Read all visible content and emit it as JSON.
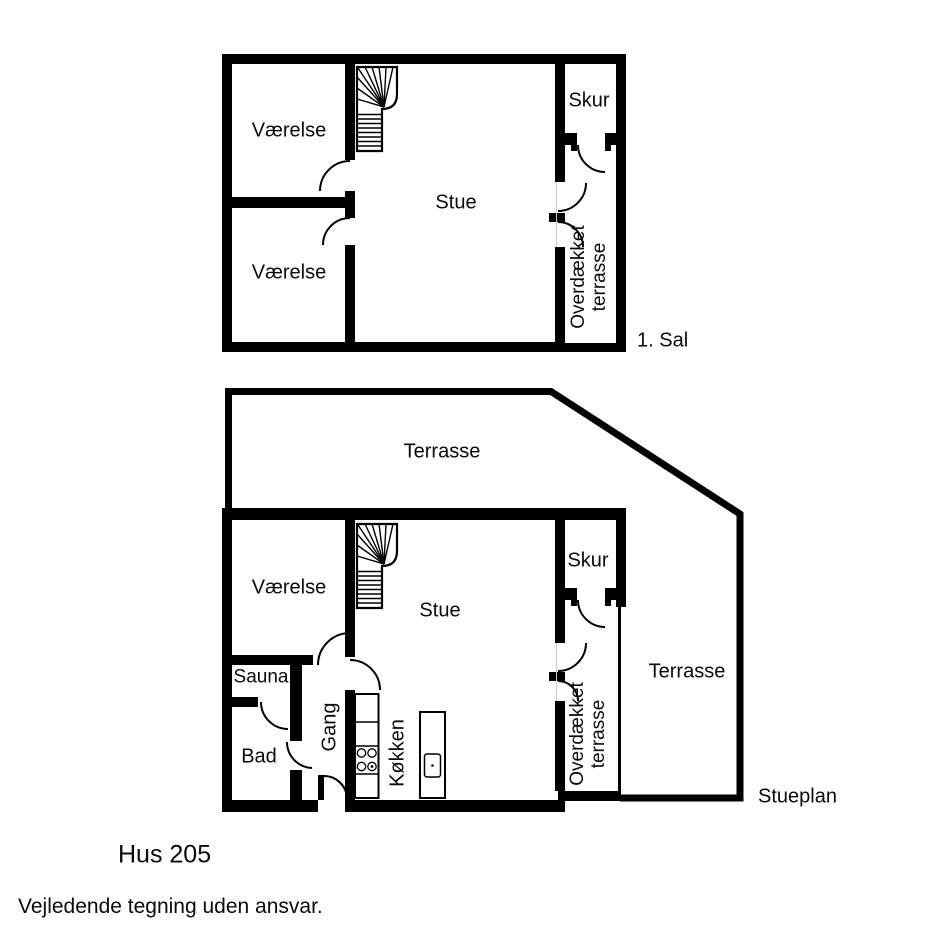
{
  "page": {
    "background": "#ffffff",
    "wall_color": "#000000"
  },
  "floor_plans": {
    "first_floor": {
      "label": "1. Sal",
      "rooms": {
        "vaerelse_top": "Værelse",
        "vaerelse_bottom": "Værelse",
        "stue": "Stue",
        "skur": "Skur",
        "overdaekket_line1": "Overdækket",
        "overdaekket_line2": "terrasse"
      }
    },
    "ground_floor": {
      "label": "Stueplan",
      "rooms": {
        "terrasse_top": "Terrasse",
        "vaerelse": "Værelse",
        "stue": "Stue",
        "skur": "Skur",
        "sauna": "Sauna",
        "bad": "Bad",
        "gang": "Gang",
        "koekken": "Køkken",
        "overdaekket_line1": "Overdækket",
        "overdaekket_line2": "terrasse",
        "terrasse_right": "Terrasse"
      }
    }
  },
  "footer": {
    "title": "Hus 205",
    "disclaimer": "Vejledende tegning uden ansvar."
  }
}
